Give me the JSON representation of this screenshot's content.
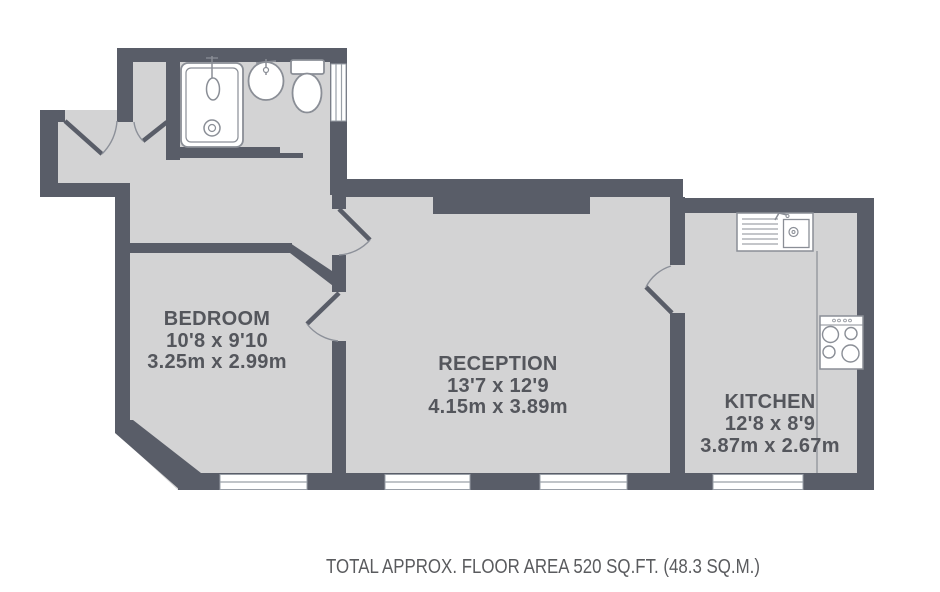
{
  "title": "Flat floor plan",
  "colors": {
    "wall": "#595d68",
    "floor": "#d3d3d4",
    "fixture_outline": "#8a8e96",
    "room_label_text": "#54565c",
    "footer_text": "#5a5b5e"
  },
  "rooms": {
    "bedroom": {
      "name": "BEDROOM",
      "imperial": "10'8 x 9'10",
      "metric": "3.25m x 2.99m"
    },
    "reception": {
      "name": "RECEPTION",
      "imperial": "13'7 x 12'9",
      "metric": "4.15m x 3.89m"
    },
    "kitchen": {
      "name": "KITCHEN",
      "imperial": "12'8 x 8'9",
      "metric": "3.87m x 2.67m"
    }
  },
  "fixtures": [
    "shower",
    "washbasin",
    "toilet",
    "bathroom-window",
    "kitchen-sink",
    "hob",
    "worktop"
  ],
  "footer": {
    "total_area": "TOTAL APPROX. FLOOR AREA 520 SQ.FT. (48.3 SQ.M.)"
  }
}
